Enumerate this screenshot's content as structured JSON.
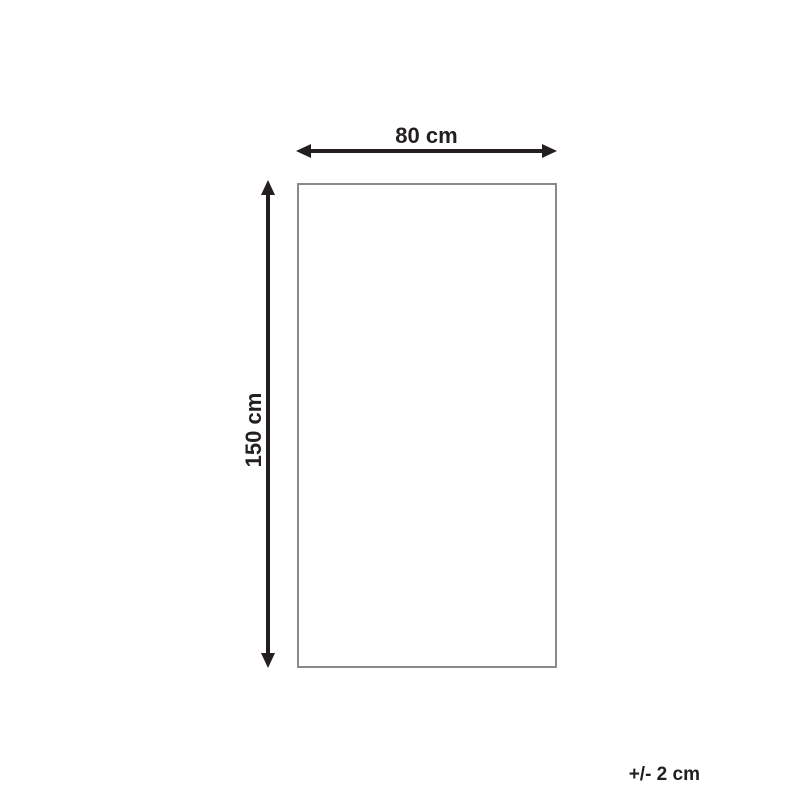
{
  "diagram": {
    "type": "product-dimension-diagram",
    "width_label": "80 cm",
    "height_label": "150 cm",
    "tolerance_label": "+/- 2 cm",
    "colors": {
      "ink": "#231f20",
      "outline": "#8a8a8a",
      "background": "#ffffff"
    }
  }
}
